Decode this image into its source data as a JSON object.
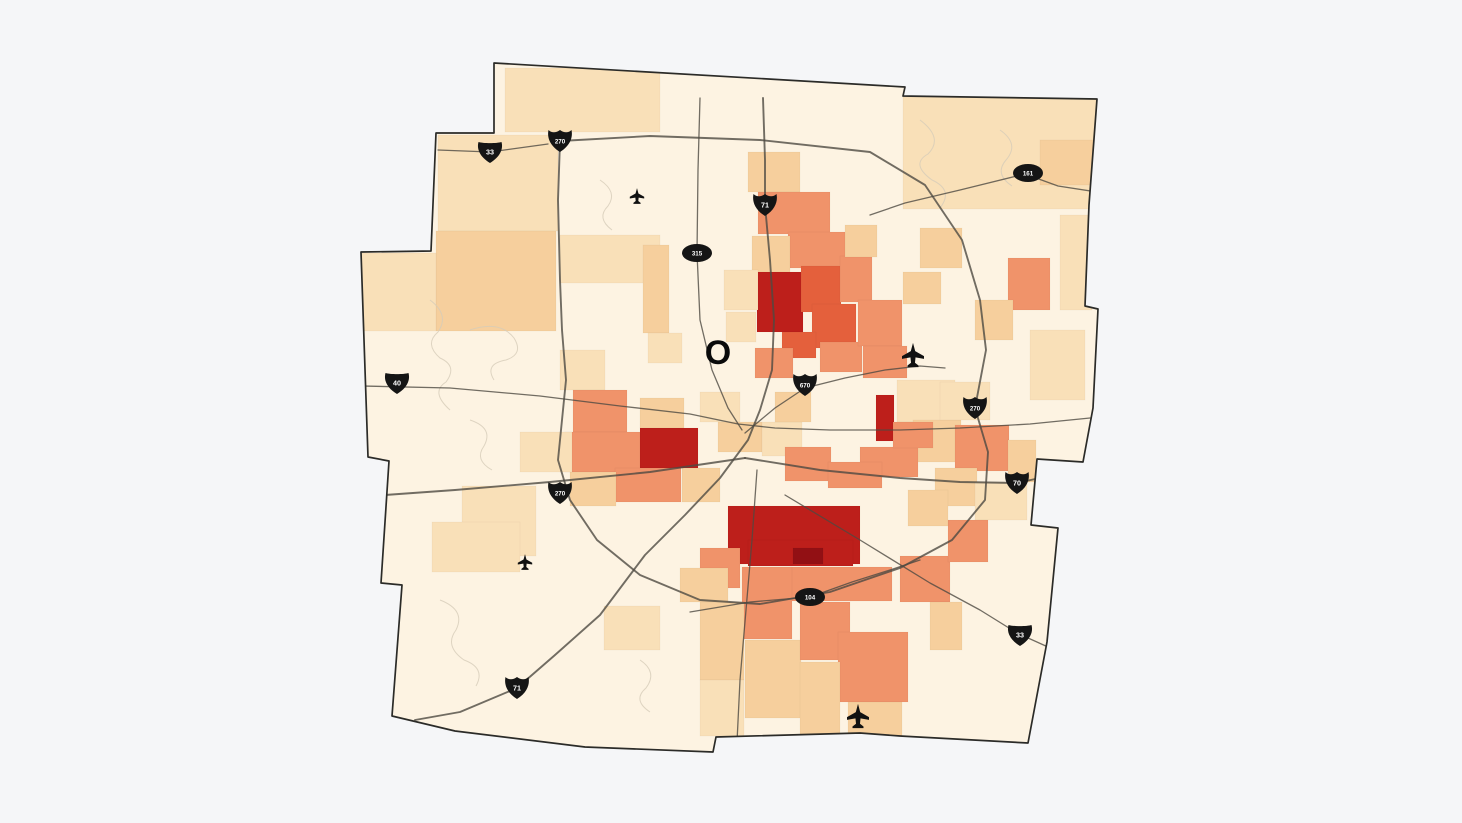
{
  "canvas": {
    "width": 1462,
    "height": 823,
    "background": "#f5f6f8"
  },
  "map": {
    "base_fill": "#fdf3e2",
    "border_color": "#2b2b28",
    "road_color": "#4e4a42",
    "decor_line_color": "#d6ccb9",
    "palette": [
      "#fdf3e2",
      "#f9e0b8",
      "#f6cf9d",
      "#f0936a",
      "#e4603c",
      "#bd1f1b",
      "#921014"
    ],
    "outline": [
      [
        494,
        63
      ],
      [
        905,
        87
      ],
      [
        903,
        96
      ],
      [
        1097,
        99
      ],
      [
        1089,
        205
      ],
      [
        1085,
        306
      ],
      [
        1098,
        309
      ],
      [
        1093,
        408
      ],
      [
        1083,
        462
      ],
      [
        1037,
        459
      ],
      [
        1031,
        525
      ],
      [
        1058,
        528
      ],
      [
        1047,
        642
      ],
      [
        1028,
        743
      ],
      [
        900,
        736
      ],
      [
        860,
        733
      ],
      [
        716,
        737
      ],
      [
        713,
        752
      ],
      [
        585,
        747
      ],
      [
        455,
        731
      ],
      [
        392,
        716
      ],
      [
        402,
        585
      ],
      [
        381,
        583
      ],
      [
        389,
        461
      ],
      [
        368,
        457
      ],
      [
        361,
        252
      ],
      [
        431,
        251
      ],
      [
        436,
        133
      ],
      [
        494,
        133
      ]
    ],
    "regions": [
      [
        505,
        68,
        155,
        64,
        1
      ],
      [
        903,
        97,
        193,
        112,
        1
      ],
      [
        1040,
        140,
        55,
        45,
        2
      ],
      [
        1060,
        215,
        32,
        95,
        1
      ],
      [
        1008,
        258,
        42,
        52,
        3
      ],
      [
        975,
        300,
        38,
        40,
        2
      ],
      [
        920,
        228,
        42,
        40,
        2
      ],
      [
        903,
        272,
        38,
        32,
        2
      ],
      [
        1030,
        330,
        55,
        70,
        1
      ],
      [
        438,
        135,
        120,
        96,
        1
      ],
      [
        436,
        231,
        120,
        100,
        2
      ],
      [
        361,
        253,
        75,
        78,
        1
      ],
      [
        560,
        235,
        100,
        48,
        1
      ],
      [
        643,
        245,
        26,
        88,
        2
      ],
      [
        648,
        333,
        34,
        30,
        1
      ],
      [
        560,
        350,
        45,
        40,
        1
      ],
      [
        748,
        152,
        52,
        40,
        2
      ],
      [
        758,
        192,
        72,
        42,
        3
      ],
      [
        788,
        232,
        58,
        36,
        3
      ],
      [
        752,
        236,
        38,
        46,
        2
      ],
      [
        757,
        272,
        46,
        60,
        5
      ],
      [
        801,
        266,
        40,
        46,
        4
      ],
      [
        812,
        304,
        44,
        44,
        4
      ],
      [
        840,
        256,
        32,
        46,
        3
      ],
      [
        782,
        332,
        34,
        26,
        4
      ],
      [
        755,
        348,
        38,
        30,
        3
      ],
      [
        820,
        342,
        42,
        30,
        3
      ],
      [
        858,
        300,
        44,
        46,
        3
      ],
      [
        863,
        346,
        44,
        32,
        3
      ],
      [
        845,
        225,
        32,
        32,
        2
      ],
      [
        724,
        270,
        34,
        40,
        1
      ],
      [
        726,
        312,
        30,
        30,
        1
      ],
      [
        897,
        380,
        58,
        42,
        1
      ],
      [
        913,
        420,
        48,
        42,
        2
      ],
      [
        955,
        425,
        54,
        46,
        3
      ],
      [
        1008,
        440,
        28,
        42,
        2
      ],
      [
        935,
        468,
        42,
        38,
        2
      ],
      [
        975,
        482,
        52,
        38,
        1
      ],
      [
        940,
        382,
        50,
        38,
        1
      ],
      [
        573,
        390,
        54,
        42,
        3
      ],
      [
        565,
        432,
        76,
        40,
        3
      ],
      [
        640,
        428,
        58,
        40,
        5
      ],
      [
        615,
        468,
        66,
        34,
        3
      ],
      [
        682,
        468,
        38,
        34,
        2
      ],
      [
        570,
        472,
        46,
        34,
        2
      ],
      [
        520,
        432,
        52,
        40,
        1
      ],
      [
        640,
        398,
        44,
        30,
        2
      ],
      [
        700,
        392,
        40,
        30,
        1
      ],
      [
        718,
        422,
        44,
        30,
        2
      ],
      [
        762,
        422,
        40,
        34,
        1
      ],
      [
        775,
        392,
        36,
        30,
        2
      ],
      [
        876,
        395,
        18,
        46,
        5
      ],
      [
        860,
        447,
        58,
        30,
        3
      ],
      [
        893,
        422,
        40,
        26,
        3
      ],
      [
        785,
        447,
        46,
        34,
        3
      ],
      [
        828,
        462,
        54,
        26,
        3
      ],
      [
        728,
        506,
        132,
        58,
        5
      ],
      [
        748,
        540,
        105,
        26,
        5
      ],
      [
        793,
        548,
        30,
        16,
        6
      ],
      [
        700,
        548,
        40,
        40,
        3
      ],
      [
        680,
        568,
        48,
        34,
        2
      ],
      [
        790,
        567,
        102,
        34,
        3
      ],
      [
        742,
        567,
        50,
        72,
        3
      ],
      [
        700,
        602,
        44,
        78,
        2
      ],
      [
        745,
        640,
        56,
        78,
        2
      ],
      [
        800,
        602,
        50,
        58,
        3
      ],
      [
        838,
        632,
        70,
        70,
        3
      ],
      [
        800,
        662,
        40,
        76,
        2
      ],
      [
        848,
        702,
        54,
        38,
        2
      ],
      [
        900,
        556,
        50,
        46,
        3
      ],
      [
        930,
        602,
        32,
        48,
        2
      ],
      [
        948,
        520,
        40,
        42,
        3
      ],
      [
        908,
        490,
        40,
        36,
        2
      ],
      [
        462,
        486,
        74,
        70,
        1
      ],
      [
        432,
        522,
        88,
        50,
        1
      ],
      [
        604,
        606,
        56,
        44,
        1
      ],
      [
        700,
        680,
        44,
        56,
        1
      ]
    ],
    "roads": [
      {
        "name": "beltway-270",
        "major": true,
        "points": [
          [
            560,
            141
          ],
          [
            650,
            136
          ],
          [
            760,
            140
          ],
          [
            870,
            152
          ],
          [
            925,
            185
          ],
          [
            962,
            240
          ],
          [
            980,
            300
          ],
          [
            986,
            350
          ],
          [
            975,
            408
          ],
          [
            988,
            452
          ],
          [
            985,
            500
          ],
          [
            952,
            540
          ],
          [
            900,
            568
          ],
          [
            830,
            592
          ],
          [
            760,
            604
          ],
          [
            700,
            600
          ],
          [
            640,
            575
          ],
          [
            597,
            540
          ],
          [
            570,
            500
          ],
          [
            558,
            460
          ],
          [
            562,
            420
          ],
          [
            566,
            380
          ],
          [
            562,
            330
          ],
          [
            560,
            280
          ],
          [
            558,
            200
          ],
          [
            560,
            141
          ]
        ]
      },
      {
        "name": "interstate-71",
        "major": true,
        "points": [
          [
            763,
            98
          ],
          [
            765,
            160
          ],
          [
            765,
            205
          ],
          [
            770,
            260
          ],
          [
            774,
            320
          ],
          [
            772,
            370
          ],
          [
            760,
            410
          ],
          [
            748,
            440
          ],
          [
            720,
            478
          ],
          [
            685,
            515
          ],
          [
            645,
            555
          ],
          [
            600,
            615
          ],
          [
            555,
            655
          ],
          [
            517,
            688
          ],
          [
            460,
            712
          ],
          [
            415,
            720
          ]
        ]
      },
      {
        "name": "route-315",
        "major": false,
        "points": [
          [
            700,
            98
          ],
          [
            698,
            170
          ],
          [
            697,
            253
          ],
          [
            700,
            320
          ],
          [
            712,
            370
          ],
          [
            728,
            408
          ],
          [
            742,
            430
          ]
        ]
      },
      {
        "name": "interstate-670",
        "major": false,
        "points": [
          [
            745,
            433
          ],
          [
            775,
            408
          ],
          [
            805,
            388
          ],
          [
            845,
            378
          ],
          [
            885,
            370
          ],
          [
            920,
            366
          ],
          [
            945,
            368
          ]
        ]
      },
      {
        "name": "us-40-broad-st",
        "major": false,
        "points": [
          [
            362,
            386
          ],
          [
            450,
            388
          ],
          [
            540,
            396
          ],
          [
            620,
            406
          ],
          [
            690,
            414
          ],
          [
            738,
            424
          ],
          [
            775,
            428
          ],
          [
            830,
            430
          ],
          [
            900,
            430
          ],
          [
            960,
            428
          ],
          [
            1030,
            424
          ],
          [
            1090,
            418
          ]
        ]
      },
      {
        "name": "interstate-70-east",
        "major": true,
        "points": [
          [
            745,
            458
          ],
          [
            820,
            470
          ],
          [
            900,
            478
          ],
          [
            960,
            482
          ],
          [
            1017,
            483
          ],
          [
            1085,
            468
          ]
        ]
      },
      {
        "name": "interstate-70-west",
        "major": true,
        "points": [
          [
            745,
            458
          ],
          [
            650,
            472
          ],
          [
            550,
            482
          ],
          [
            455,
            490
          ],
          [
            385,
            495
          ]
        ]
      },
      {
        "name": "us-33-northwest",
        "major": false,
        "points": [
          [
            438,
            150
          ],
          [
            490,
            152
          ],
          [
            548,
            144
          ]
        ]
      },
      {
        "name": "us-33-southeast",
        "major": false,
        "points": [
          [
            785,
            495
          ],
          [
            860,
            540
          ],
          [
            930,
            583
          ],
          [
            980,
            610
          ],
          [
            1017,
            633
          ],
          [
            1048,
            647
          ]
        ]
      },
      {
        "name": "route-161",
        "major": false,
        "points": [
          [
            870,
            215
          ],
          [
            905,
            203
          ],
          [
            960,
            190
          ],
          [
            1025,
            174
          ],
          [
            1058,
            186
          ],
          [
            1097,
            192
          ]
        ]
      },
      {
        "name": "route-104",
        "major": false,
        "points": [
          [
            690,
            612
          ],
          [
            750,
            602
          ],
          [
            810,
            597
          ],
          [
            852,
            582
          ],
          [
            890,
            570
          ],
          [
            920,
            560
          ]
        ]
      },
      {
        "name": "high-st-south",
        "major": false,
        "points": [
          [
            757,
            470
          ],
          [
            752,
            540
          ],
          [
            746,
            610
          ],
          [
            740,
            680
          ],
          [
            737,
            742
          ]
        ]
      }
    ],
    "route_markers": [
      {
        "type": "us",
        "label": "33",
        "x": 490,
        "y": 152
      },
      {
        "type": "interstate",
        "label": "270",
        "x": 560,
        "y": 141
      },
      {
        "type": "interstate",
        "label": "71",
        "x": 765,
        "y": 205
      },
      {
        "type": "oval",
        "label": "315",
        "x": 697,
        "y": 253
      },
      {
        "type": "oval",
        "label": "161",
        "x": 1028,
        "y": 173
      },
      {
        "type": "us",
        "label": "40",
        "x": 397,
        "y": 383
      },
      {
        "type": "interstate",
        "label": "670",
        "x": 805,
        "y": 385
      },
      {
        "type": "interstate",
        "label": "270",
        "x": 975,
        "y": 408
      },
      {
        "type": "interstate",
        "label": "270",
        "x": 560,
        "y": 493
      },
      {
        "type": "interstate",
        "label": "70",
        "x": 1017,
        "y": 483
      },
      {
        "type": "oval",
        "label": "104",
        "x": 810,
        "y": 597
      },
      {
        "type": "us",
        "label": "33",
        "x": 1020,
        "y": 635
      },
      {
        "type": "interstate",
        "label": "71",
        "x": 517,
        "y": 688
      }
    ],
    "poi_markers": [
      {
        "type": "airplane-icon",
        "x": 637,
        "y": 196,
        "scale": 0.72
      },
      {
        "type": "airplane-icon",
        "x": 913,
        "y": 355,
        "scale": 1.1
      },
      {
        "type": "airplane-icon",
        "x": 525,
        "y": 562,
        "scale": 0.72
      },
      {
        "type": "airplane-icon",
        "x": 858,
        "y": 716,
        "scale": 1.1
      },
      {
        "type": "letter-marker",
        "label": "O",
        "x": 718,
        "y": 364
      }
    ]
  }
}
